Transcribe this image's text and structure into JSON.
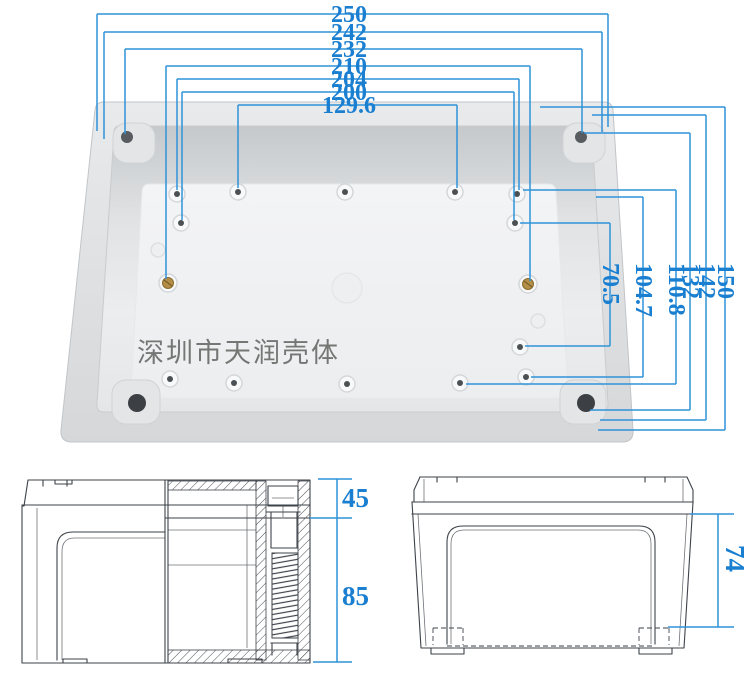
{
  "watermark": {
    "text": "深圳市天润壳体"
  },
  "colors": {
    "dim_line": "#2f93da",
    "dim_text": "#1a7fd0",
    "line_art": "#3e434a",
    "watermark": "#6b6d6a",
    "brass": "#b28e46"
  },
  "plan_view": {
    "h_dims": [
      {
        "label": "250"
      },
      {
        "label": "242"
      },
      {
        "label": "232"
      },
      {
        "label": "210"
      },
      {
        "label": "204"
      },
      {
        "label": "200"
      },
      {
        "label": "129.6"
      }
    ],
    "v_dims": [
      {
        "label": "150"
      },
      {
        "label": "142"
      },
      {
        "label": "132"
      },
      {
        "label": "110.8"
      },
      {
        "label": "104.7"
      },
      {
        "label": "70.5"
      }
    ]
  },
  "section_view": {
    "dims": [
      {
        "label": "45"
      },
      {
        "label": "85"
      }
    ]
  },
  "front_view": {
    "dims": [
      {
        "label": "74"
      }
    ]
  }
}
